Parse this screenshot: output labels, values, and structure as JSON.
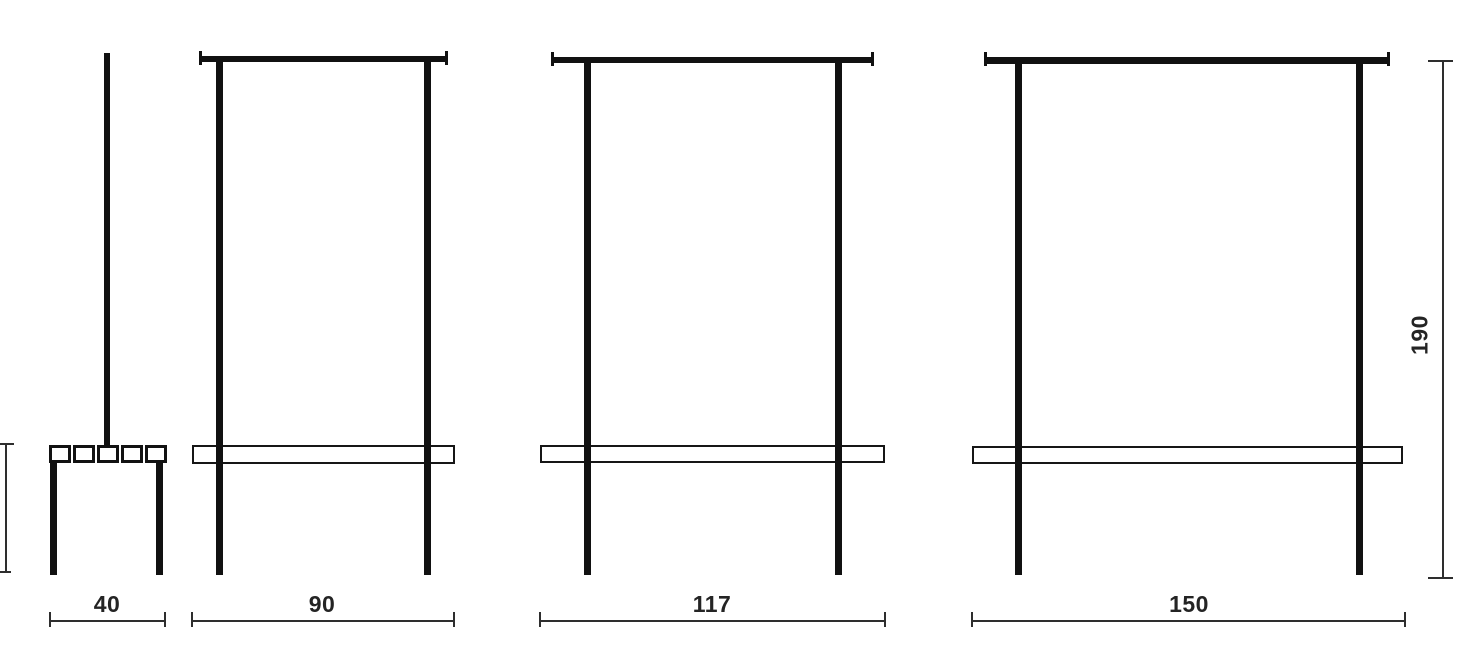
{
  "drawing": {
    "kind": "furniture-dimension-line-drawing",
    "views": [
      {
        "name": "bench-side-view",
        "width_label": "40"
      },
      {
        "name": "coat-rack-front-view-90",
        "width_label": "90"
      },
      {
        "name": "coat-rack-front-view-117",
        "width_label": "117"
      },
      {
        "name": "coat-rack-front-view-150",
        "width_label": "150"
      }
    ],
    "height_label": "190",
    "colors": {
      "structure_line": "#111111",
      "dimension_line": "#2e2e2e",
      "background": "#ffffff"
    }
  }
}
